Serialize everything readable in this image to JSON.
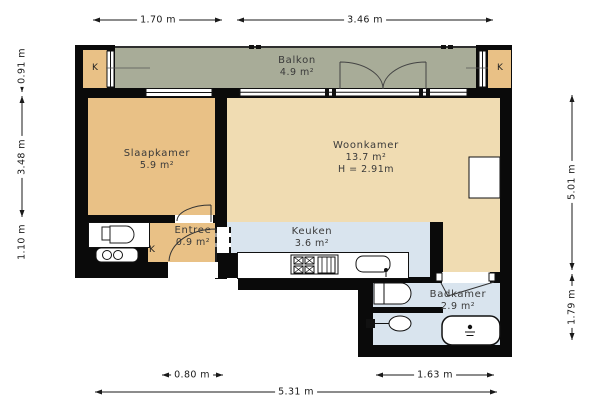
{
  "plan": {
    "rooms": {
      "balkon": {
        "name": "Balkon",
        "area": "4.9 m²"
      },
      "slaapkamer": {
        "name": "Slaapkamer",
        "area": "5.9 m²"
      },
      "woonkamer": {
        "name": "Woonkamer",
        "area": "13.7 m²",
        "ceiling_height": "H = 2.91m"
      },
      "entree": {
        "name": "Entree",
        "area": "0.9 m²"
      },
      "keuken": {
        "name": "Keuken",
        "area": "3.6 m²"
      },
      "badkamer": {
        "name": "Badkamer",
        "area": "2.9 m²"
      }
    },
    "closet_label": "K",
    "dimensions": {
      "top": [
        "1.70 m",
        "3.46 m"
      ],
      "left": [
        "0.91 m",
        "3.48 m",
        "1.10 m"
      ],
      "right": [
        "5.01 m",
        "1.79 m"
      ],
      "bottom": [
        "0.80 m",
        "1.63 m",
        "5.31 m"
      ]
    },
    "colors": {
      "wall": "#0a0a0a",
      "room_tan": "#e9c186",
      "room_cream": "#f0dcb2",
      "room_wet_blue": "#d9e4ee",
      "balcony_gray": "#a8ac98",
      "label_text": "#3a3a3a"
    },
    "fixtures": [
      "toilet",
      "meter-box",
      "stove",
      "kitchen-sink",
      "washbasin",
      "wall-toilet",
      "shower-tray",
      "radiator",
      "french-doors",
      "closet"
    ]
  }
}
